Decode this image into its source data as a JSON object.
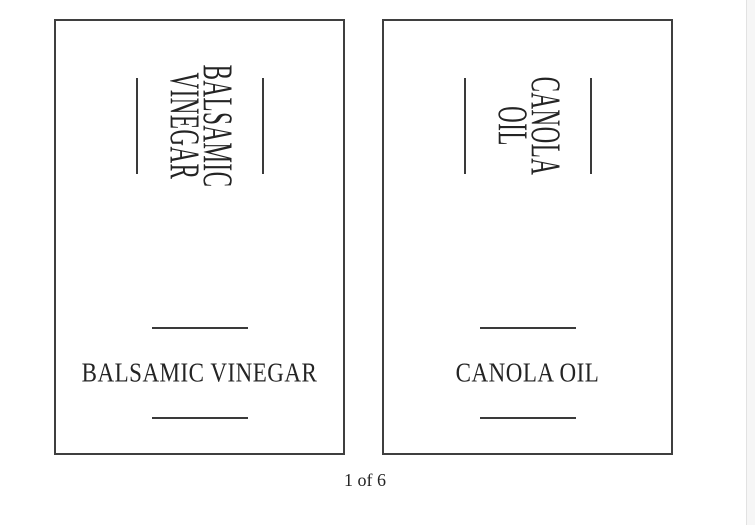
{
  "viewer": {
    "page_indicator": "1 of 6",
    "background_color": "#ffffff",
    "text_color": "#242424",
    "card_border_color": "#3f3f3f",
    "rule_color": "#3a3a3a",
    "scrollbar_track_color": "#f6f6f6",
    "scrollbar_edge_color": "#e2e2e2"
  },
  "labels": [
    {
      "id": "balsamic-vinegar",
      "vertical_text_line1": "BALSAMIC",
      "vertical_text_line2": "VINEGAR",
      "horizontal_text": "BALSAMIC VINEGAR"
    },
    {
      "id": "canola-oil",
      "vertical_text_line1": "CANOLA",
      "vertical_text_line2": "OIL",
      "horizontal_text": "CANOLA OIL"
    }
  ]
}
